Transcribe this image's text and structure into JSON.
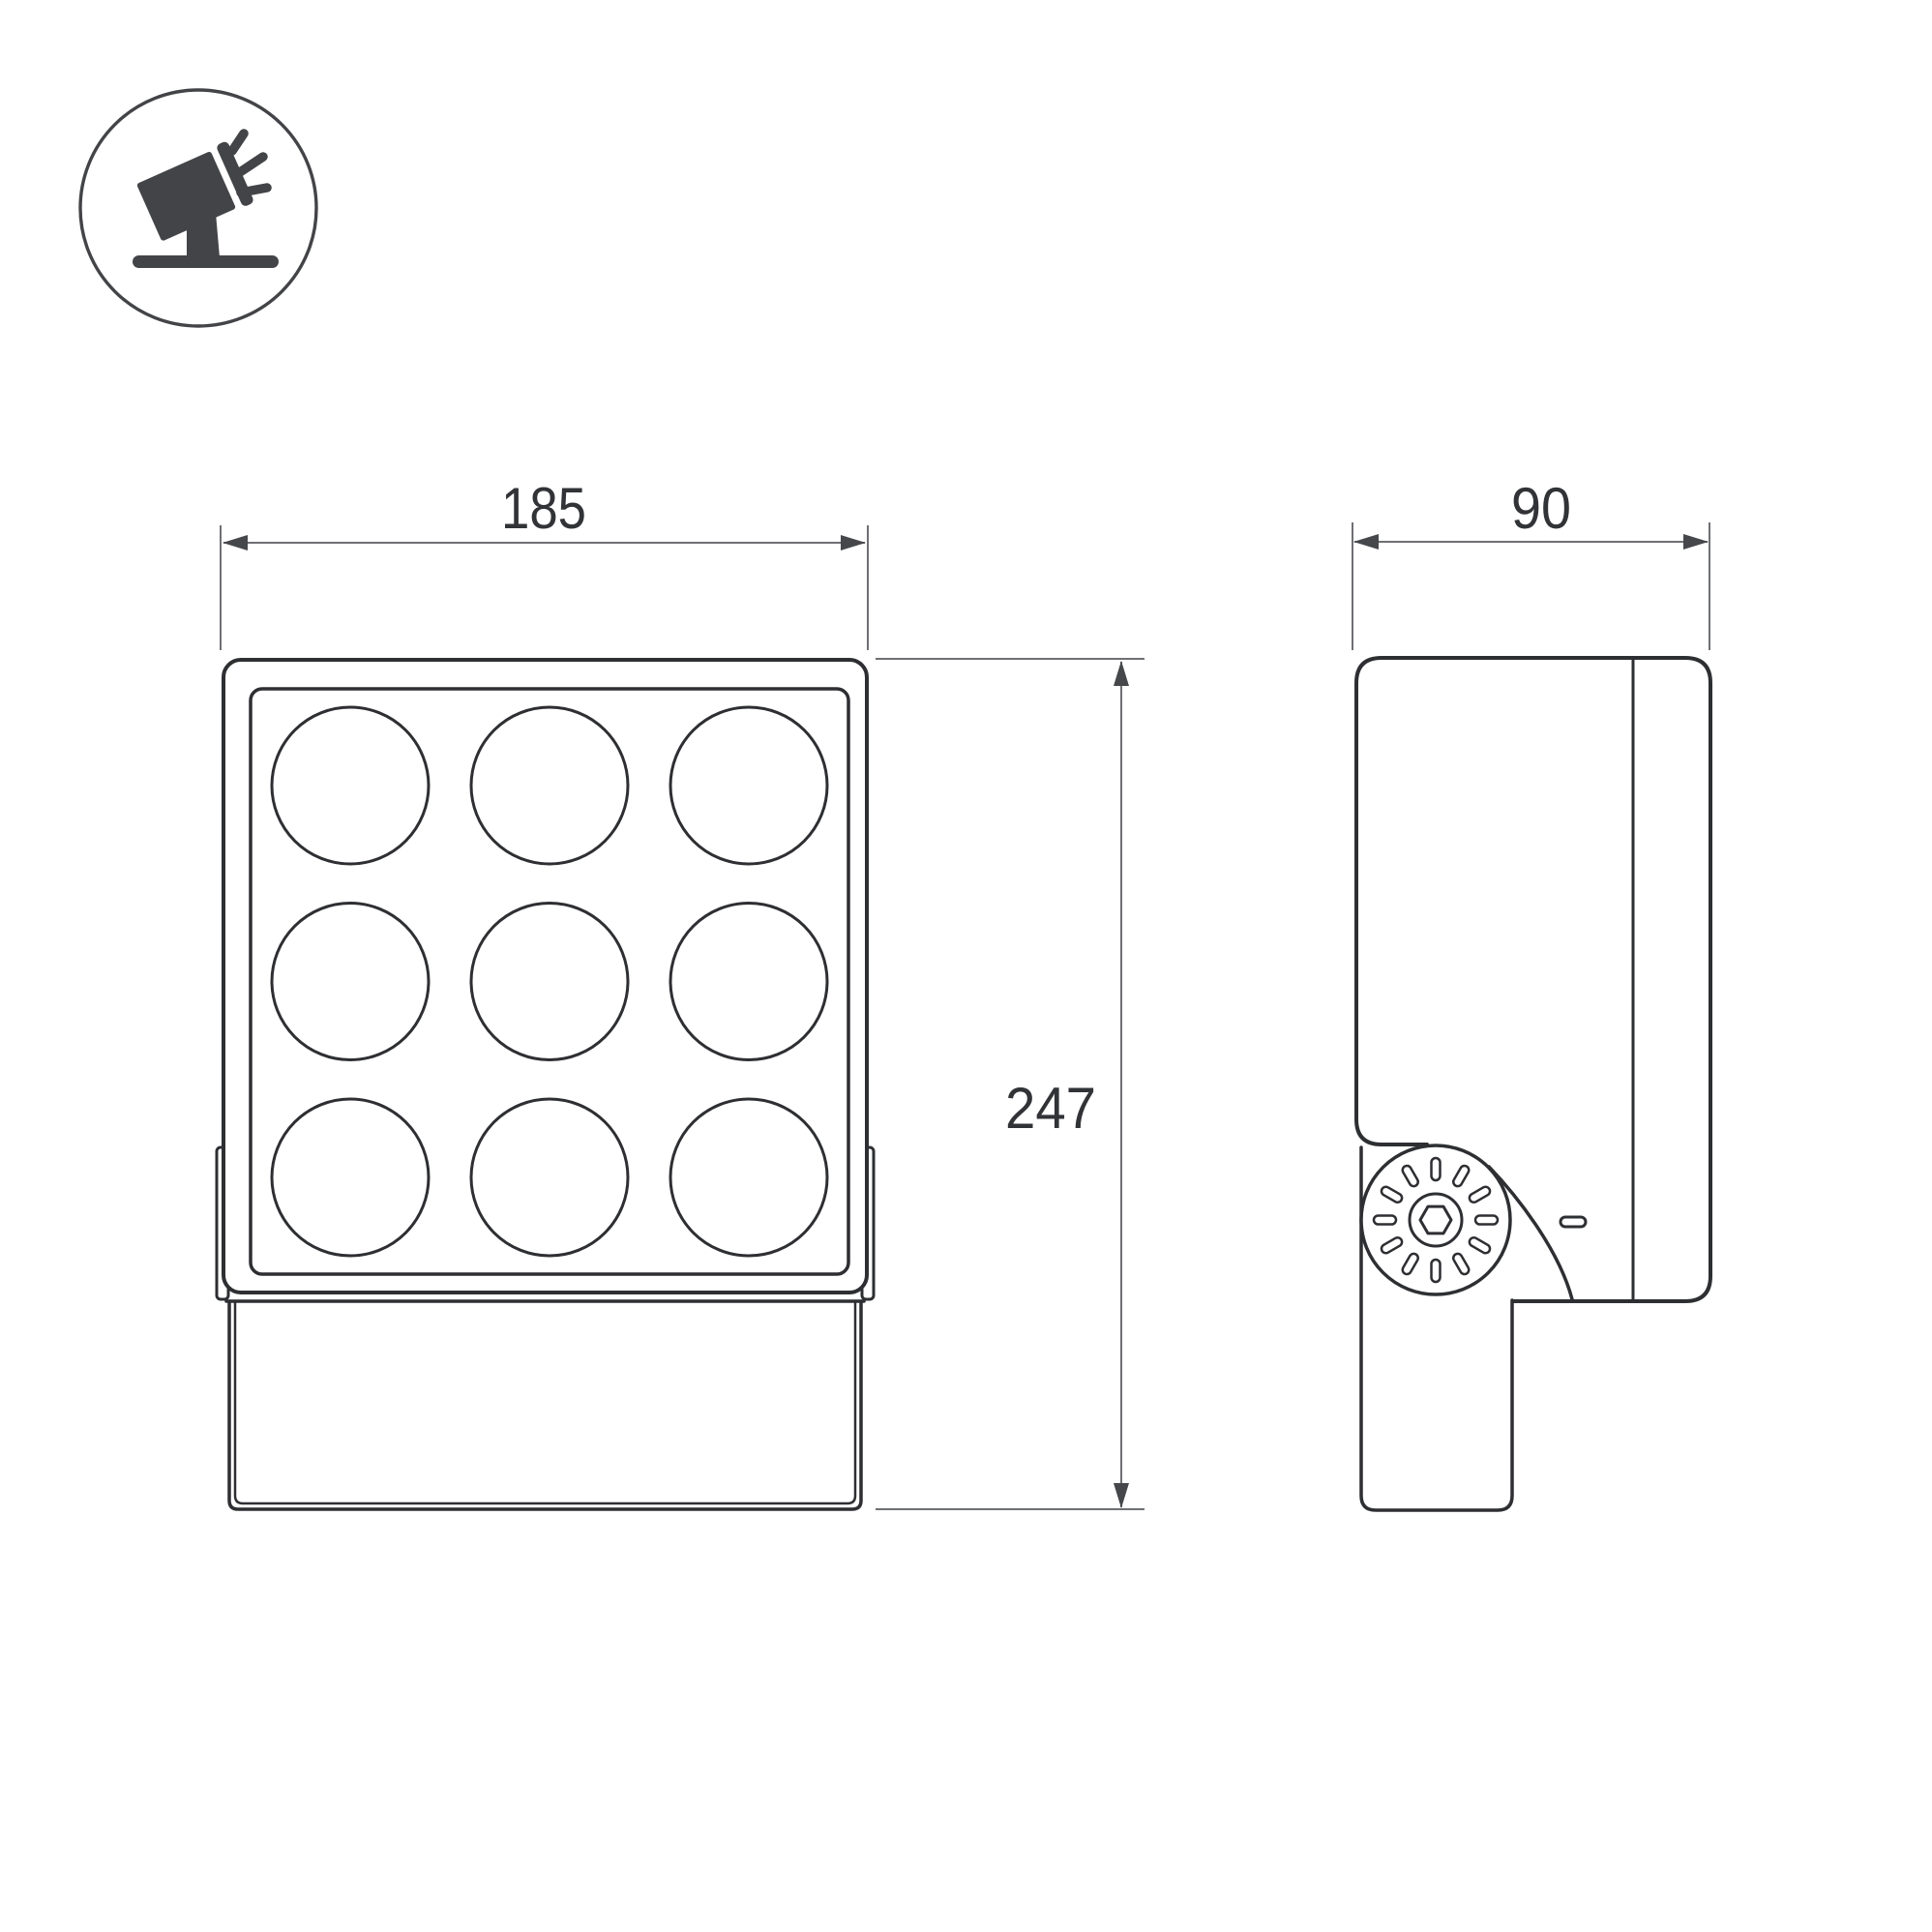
{
  "drawing": {
    "type": "technical-dimension-drawing",
    "views": {
      "front": {
        "name": "front view",
        "lens_rows": 3,
        "lens_cols": 3,
        "lens_count": 9
      },
      "side": {
        "name": "side view",
        "knurl_slot_count": 12,
        "pivot_screw": "hex-socket"
      }
    }
  },
  "icon": {
    "name": "adjustable-floodlight-on-stand",
    "ray_count": 3
  },
  "dimensions": {
    "width": {
      "value": "185"
    },
    "height": {
      "value": "247"
    },
    "depth": {
      "value": "90"
    }
  },
  "colors": {
    "background": "#ffffff",
    "object_line": "#2e2f32",
    "dim_line": "#6f7074",
    "arrow_fill": "#46474b",
    "text_color": "#323337",
    "icon_color": "#434447"
  }
}
